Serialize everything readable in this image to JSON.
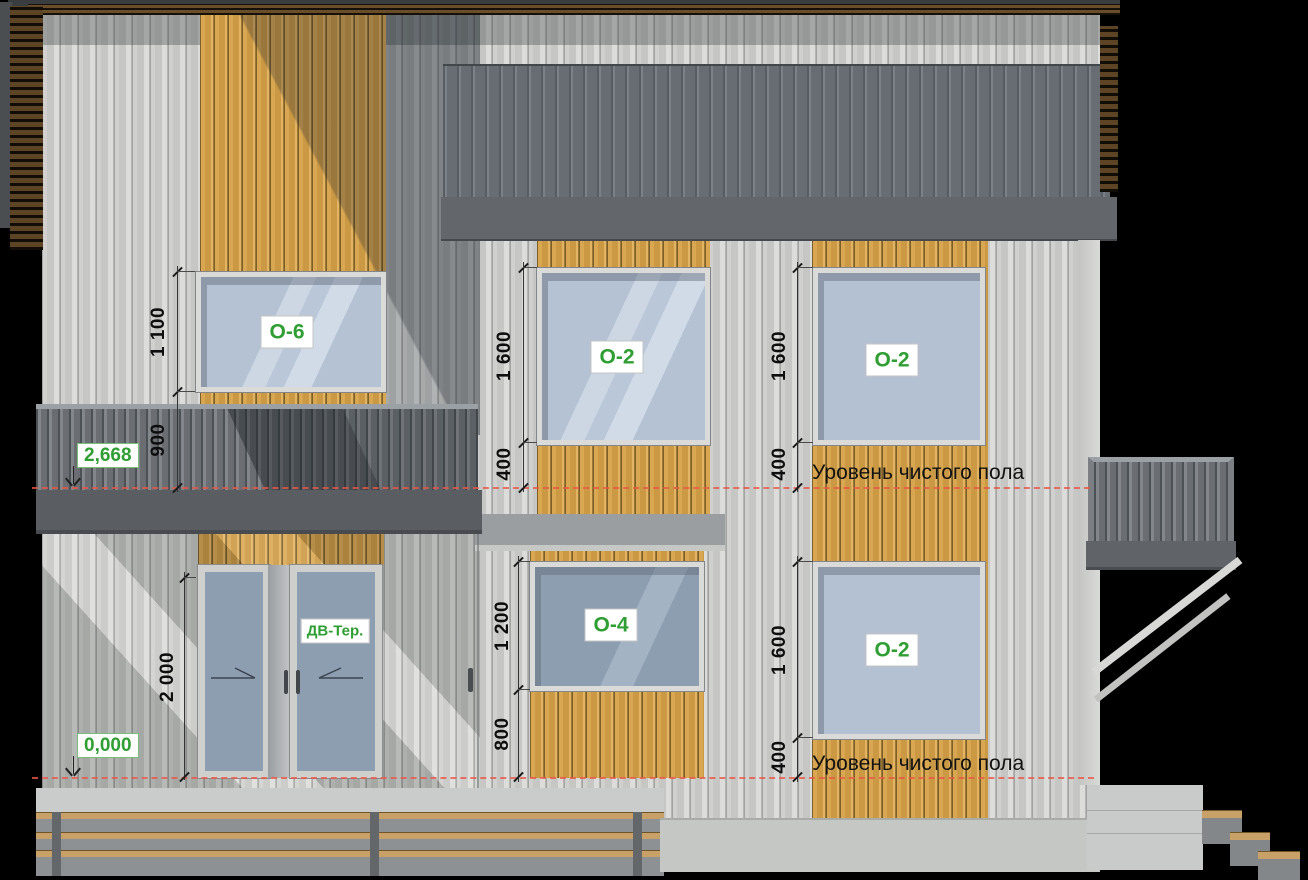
{
  "drawing": {
    "type": "house facade elevation",
    "floor_level_label": "Уровень чистого пола"
  },
  "levels": {
    "second_floor": "2,668",
    "ground_floor": "0,000"
  },
  "dimensions": {
    "o6_height": "1 100",
    "balcony_parapet": "900",
    "terrace_door_height": "2 000",
    "o2_mid_height": "1 600",
    "o2_mid_sill": "400",
    "o4_height": "1 200",
    "o4_sill": "800",
    "o2_right_top_height": "1 600",
    "o2_right_top_sill": "400",
    "o2_right_bottom_height": "1 600",
    "o2_right_bottom_sill": "400"
  },
  "tags": {
    "window_o6": "О-6",
    "window_o2_mid": "О-2",
    "window_o2_right_top": "О-2",
    "window_o2_right_bottom": "О-2",
    "window_o4": "О-4",
    "terrace_door": "ДВ-Тер."
  },
  "colors": {
    "tag_green": "#2f9e33",
    "level_line_red": "#e8604f",
    "wood_siding": "#d3a04a",
    "metal_siding": "#cdcecb",
    "roof_gray": "#697077"
  }
}
